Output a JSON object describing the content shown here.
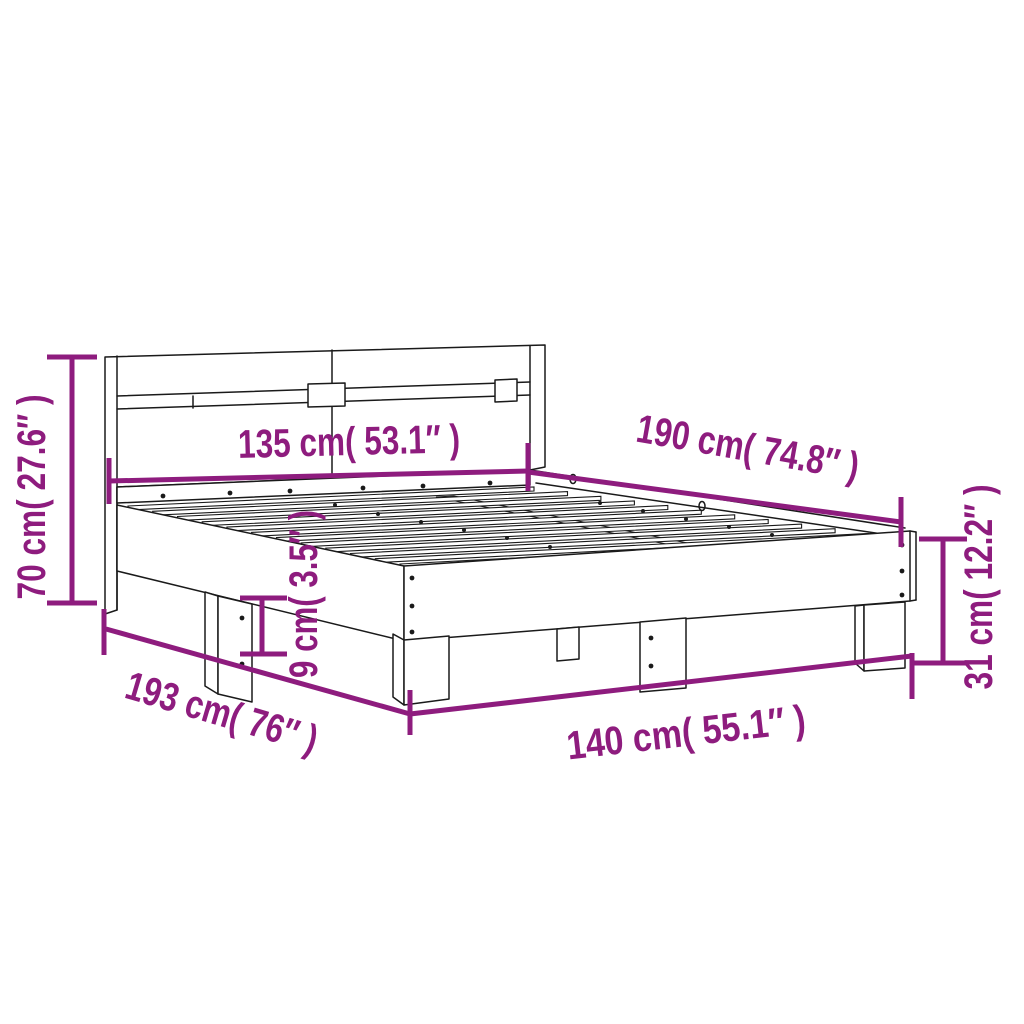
{
  "page": {
    "type": "product-dimension-diagram",
    "subject": "bed frame with headboard and slatted base",
    "background": "#ffffff"
  },
  "colors": {
    "dimension_accent": "#8e1c7e",
    "line_art": "#1a1a1a"
  },
  "dimensions": {
    "headboard_height_label": "70 cm( 27.6″ )",
    "headboard_width_label": "135 cm( 53.1″ )",
    "mattress_length_label": "190 cm( 74.8″ )",
    "frame_height_label": "31 cm( 12.2″ )",
    "leg_height_label": "9 cm( 3.5″ )",
    "total_length_label": "193 cm( 76″ )",
    "frame_width_label": "140 cm( 55.1″ )"
  }
}
